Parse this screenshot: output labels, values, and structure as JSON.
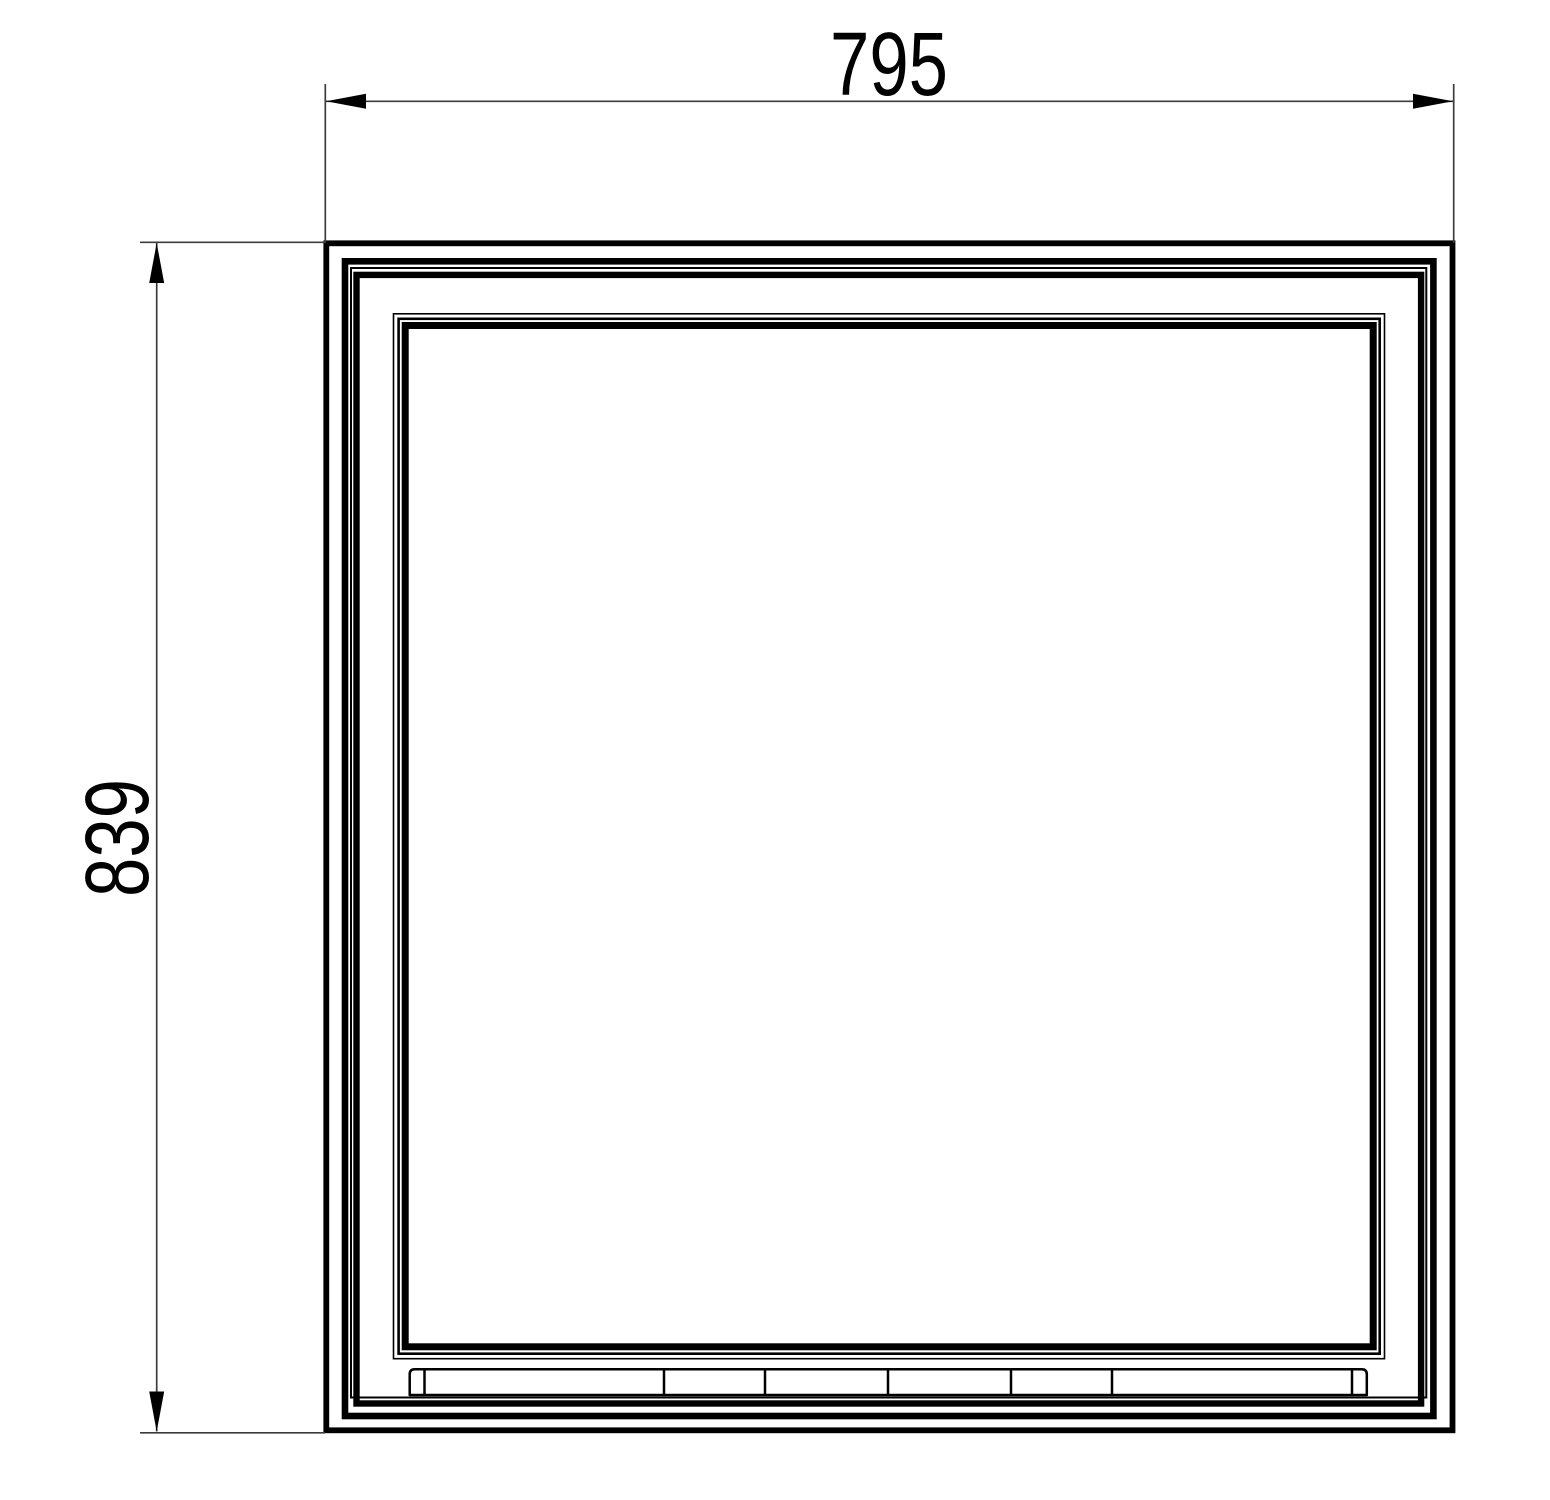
{
  "drawing": {
    "dimensions": {
      "width": {
        "label": "795"
      },
      "height": {
        "label": "839"
      }
    }
  },
  "style": {
    "line_color": "#000000",
    "dim_color": "#3d3d3d",
    "text_color": "#000000",
    "background": "#ffffff"
  }
}
